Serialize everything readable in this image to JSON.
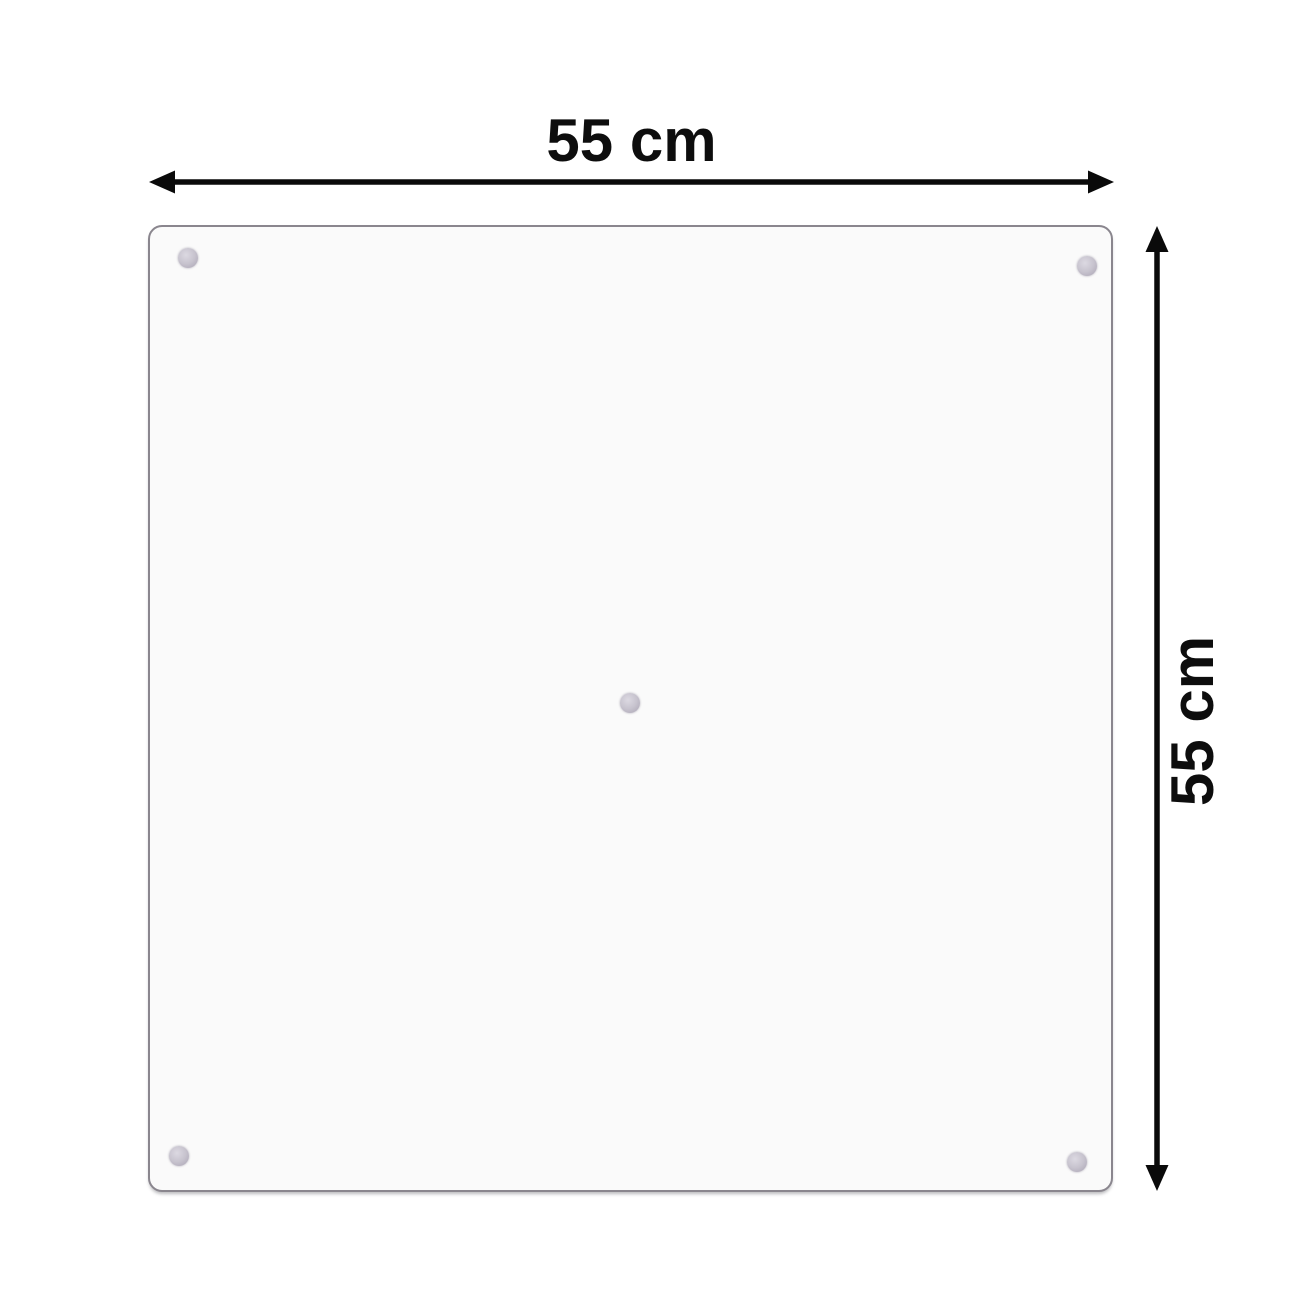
{
  "diagram": {
    "width_label": "55 cm",
    "height_label": "55 cm",
    "panel": {
      "kind": "glass-panel",
      "suction_cup_positions": [
        "top-left",
        "top-right",
        "center",
        "bottom-left",
        "bottom-right"
      ]
    }
  },
  "colors": {
    "background": "#ffffff",
    "arrow": "#0a0a0a",
    "label_text": "#0d0d0d",
    "panel_fill": "#fafafa",
    "panel_border": "#8a868e",
    "suction_cup": "#c0bbc9"
  }
}
